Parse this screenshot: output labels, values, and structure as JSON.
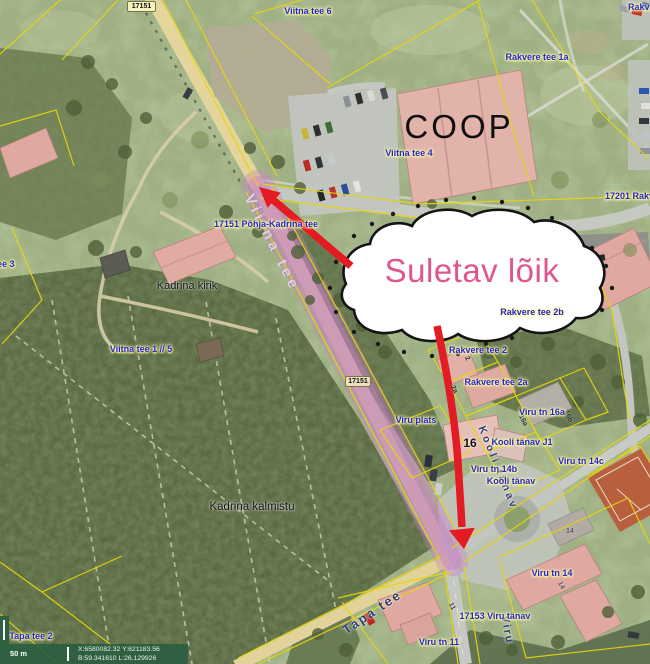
{
  "annotation": {
    "bubble_text": "Suletav lõik"
  },
  "badges": {
    "road_top": "17151",
    "road_mid": "17151"
  },
  "places": {
    "coop": "COOP",
    "church": "Kadrina kirik",
    "cemetery": "Kadrina kalmistu",
    "building_16": "16"
  },
  "address_labels": [
    {
      "text": "Viitna tee 6"
    },
    {
      "text": "Rakvere tee"
    },
    {
      "text": "Rakvere tee 1a"
    },
    {
      "text": "Viitna tee 4"
    },
    {
      "text": "17201 Rakvere tee"
    },
    {
      "text": "17151 Põhja-Kadrina tee"
    },
    {
      "text": "tee 3"
    },
    {
      "text": "Viitna tee 1 // 5"
    },
    {
      "text": "Rakvere tee 2b"
    },
    {
      "text": "Rakvere tee 2"
    },
    {
      "text": "Rakvere tee 2a"
    },
    {
      "text": "Viru tn 16a"
    },
    {
      "text": "Viru plats"
    },
    {
      "text": "Kooli tänav J1"
    },
    {
      "text": "Viru tn 14c"
    },
    {
      "text": "Viru tn 14b"
    },
    {
      "text": "Kooli tänav"
    },
    {
      "text": "Viru tn 14"
    },
    {
      "text": "17153 Viru tänav"
    },
    {
      "text": "Viru tn 11"
    },
    {
      "text": "Tapa tee 2"
    }
  ],
  "street_names": [
    {
      "text": "Viitna tee"
    },
    {
      "text": "Kooli tänav"
    },
    {
      "text": "Tapa tee"
    },
    {
      "text": "Viru"
    }
  ],
  "parcel_numbers": [
    {
      "text": "2"
    },
    {
      "text": "2a"
    },
    {
      "text": "16a"
    },
    {
      "text": "16b"
    },
    {
      "text": "14"
    },
    {
      "text": "14"
    },
    {
      "text": "11"
    }
  ],
  "statusbar": {
    "scale": "50 m",
    "coord_xy": "X:6580082.32 Y:621183.56",
    "coord_bl": "B:59.341610 L:26.129926"
  },
  "colors": {
    "closure_highlight": "#c77fc4",
    "annotation_red": "#e31b22",
    "bubble_text_pink": "#e0558f",
    "cadastral_yellow": "#e8d60a",
    "address_blue": "#2525cc"
  }
}
